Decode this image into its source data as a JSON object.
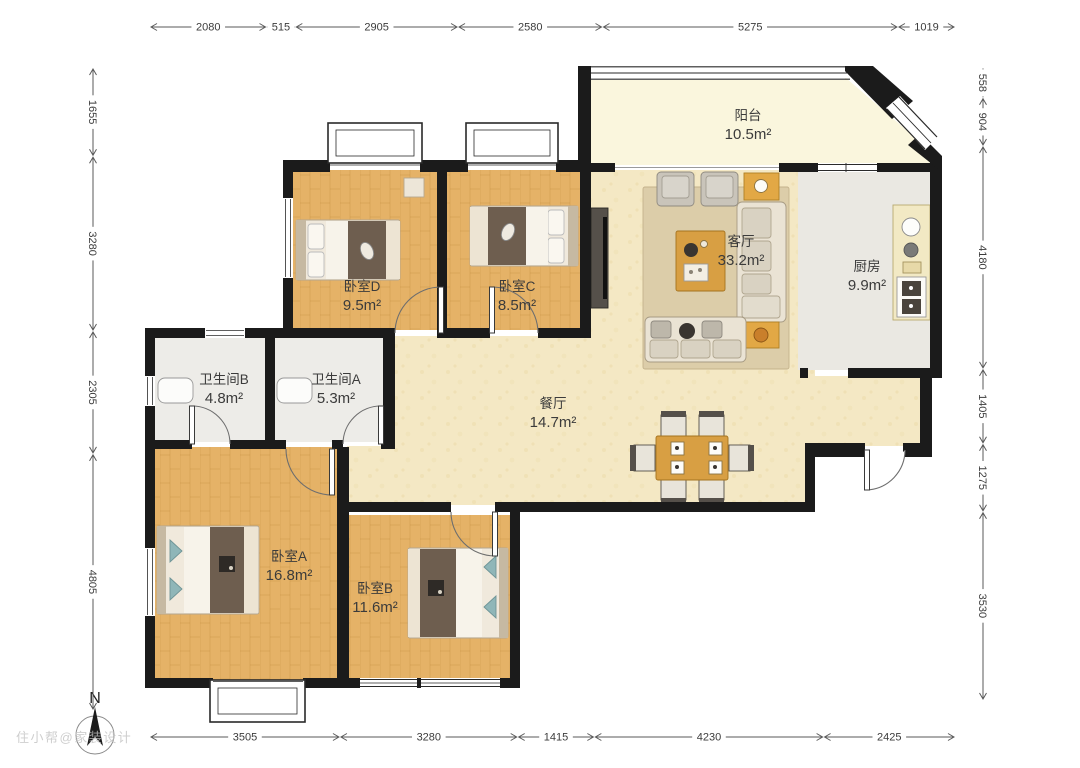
{
  "title": "户型图",
  "compass": {
    "label": "N"
  },
  "watermark": "住小帮@家装设计",
  "rooms": [
    {
      "id": "balcony",
      "name": "阳台",
      "area": "10.5m²"
    },
    {
      "id": "living",
      "name": "客厅",
      "area": "33.2m²"
    },
    {
      "id": "kitchen",
      "name": "厨房",
      "area": "9.9m²"
    },
    {
      "id": "bedroom-d",
      "name": "卧室D",
      "area": "9.5m²"
    },
    {
      "id": "bedroom-c",
      "name": "卧室C",
      "area": "8.5m²"
    },
    {
      "id": "bath-b",
      "name": "卫生间B",
      "area": "4.8m²"
    },
    {
      "id": "bath-a",
      "name": "卫生间A",
      "area": "5.3m²"
    },
    {
      "id": "dining",
      "name": "餐厅",
      "area": "14.7m²"
    },
    {
      "id": "bedroom-a",
      "name": "卧室A",
      "area": "16.8m²"
    },
    {
      "id": "bedroom-b",
      "name": "卧室B",
      "area": "11.6m²"
    }
  ],
  "dimensions": {
    "top": [
      "2080",
      "515",
      "2905",
      "2580",
      "5275",
      "1019"
    ],
    "left": [
      "1655",
      "3280",
      "2305",
      "4805"
    ],
    "right": [
      "558",
      "904",
      "4180",
      "1405",
      "1275",
      "3530"
    ],
    "bottom": [
      "3505",
      "3280",
      "1415",
      "4230",
      "2425"
    ]
  },
  "colors": {
    "wall": "#1b1b1b",
    "wood_floor": "#e5b267",
    "living_floor": "#f4e8c4",
    "balcony_floor": "#faf6dd",
    "tile_floor": "#eae8e2",
    "dimension_text": "#3c3c3c"
  }
}
